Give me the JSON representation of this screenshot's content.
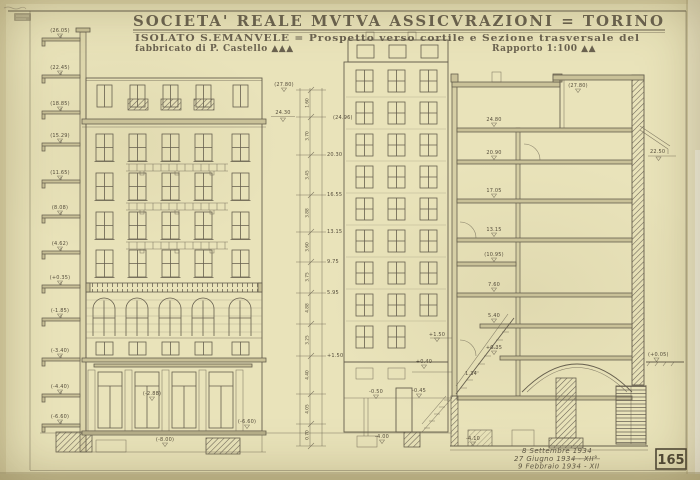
{
  "title": {
    "line1": "SOCIETA' REALE MVTVA ASSICVRAZIONI = TORINO",
    "line2": "ISOLATO S.EMANVELE = Prospetto verso cortile e Sezione trasversale del",
    "line3_left": "fabbricato di P. Castello ▲▲▲",
    "line3_right": "Rapporto 1:100 ▲▲"
  },
  "footer": {
    "date1": "8 Settembre 1934",
    "date2": "27 Giugno 1934 - XII°",
    "date3": "9 Febbraio 1934 - XII",
    "sheet_number": "165"
  },
  "left_levels": [
    "(26.05)",
    "(22.45)",
    "(18.85)",
    "(15.29)",
    "(11.65)",
    "(8.08)",
    "(4.62)",
    "(+0.35)",
    "(-1.85)",
    "(-3.40)",
    "(-4.40)",
    "(-6.60)"
  ],
  "facade": {
    "mid": "(-2.88)",
    "low1": "(-6.60)",
    "low2": "(-8.00)"
  },
  "chain": {
    "top": "(27.80)",
    "datum": "24.30",
    "datum2": "(24.96)",
    "dims": [
      "1.60",
      "3.70",
      "3.45",
      "3.88",
      "3.60",
      "3.75",
      "4.88",
      "3.25",
      "4.40",
      "4.05",
      "0.70"
    ],
    "right": [
      "20.30",
      "16.55",
      "13.15",
      "9.75",
      "5.95",
      "+1.50"
    ]
  },
  "section": {
    "roof": "(27.80)",
    "right1": "22.50",
    "right2": "(+0.05)",
    "floors": [
      "24.80",
      "20.90",
      "17.05",
      "13.15",
      "(10.95)",
      "7.60",
      "5.40",
      "+0.35"
    ],
    "stairs": [
      "+1.50",
      "+0.40",
      "1.34",
      "-0.45",
      "-0.50"
    ],
    "basement": [
      "-4.00",
      "-4.10"
    ]
  },
  "colors": {
    "paper": "#e9e3ba",
    "ink": "#665f4e",
    "edge": "#c6bd92"
  }
}
